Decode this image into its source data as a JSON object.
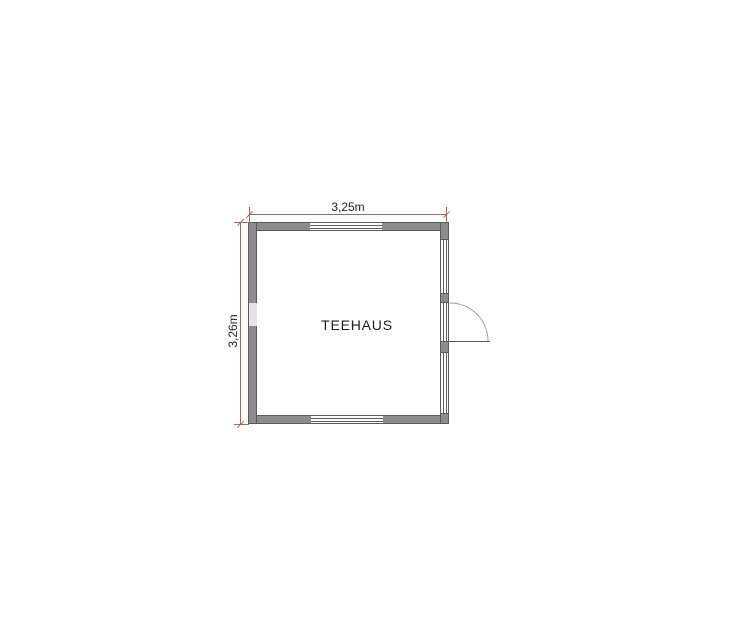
{
  "page": {
    "background": "#ffffff"
  },
  "plan": {
    "room_label": "TEEHAUS",
    "dimensions": {
      "width_label": "3,25m",
      "height_label": "3,26m"
    },
    "colors": {
      "background": "#ffffff",
      "wall": "#8c8c8c",
      "wall_outline": "#5a5a5a",
      "window_line": "#5a5a5a",
      "window_fill": "#ffffff",
      "light_panel": "#e3e3e3",
      "dimension": "#b2605f",
      "text": "#1f1f1f",
      "door_arc": "#9a9a9a",
      "door_leaf": "#5a5a5a"
    },
    "symbols": {
      "door": "door-swing-right-icon",
      "top_window": "window-icon",
      "bottom_window": "window-icon",
      "right_wall": "glazed-wall-icon",
      "left_wall_panel": "window-panel-icon"
    }
  }
}
